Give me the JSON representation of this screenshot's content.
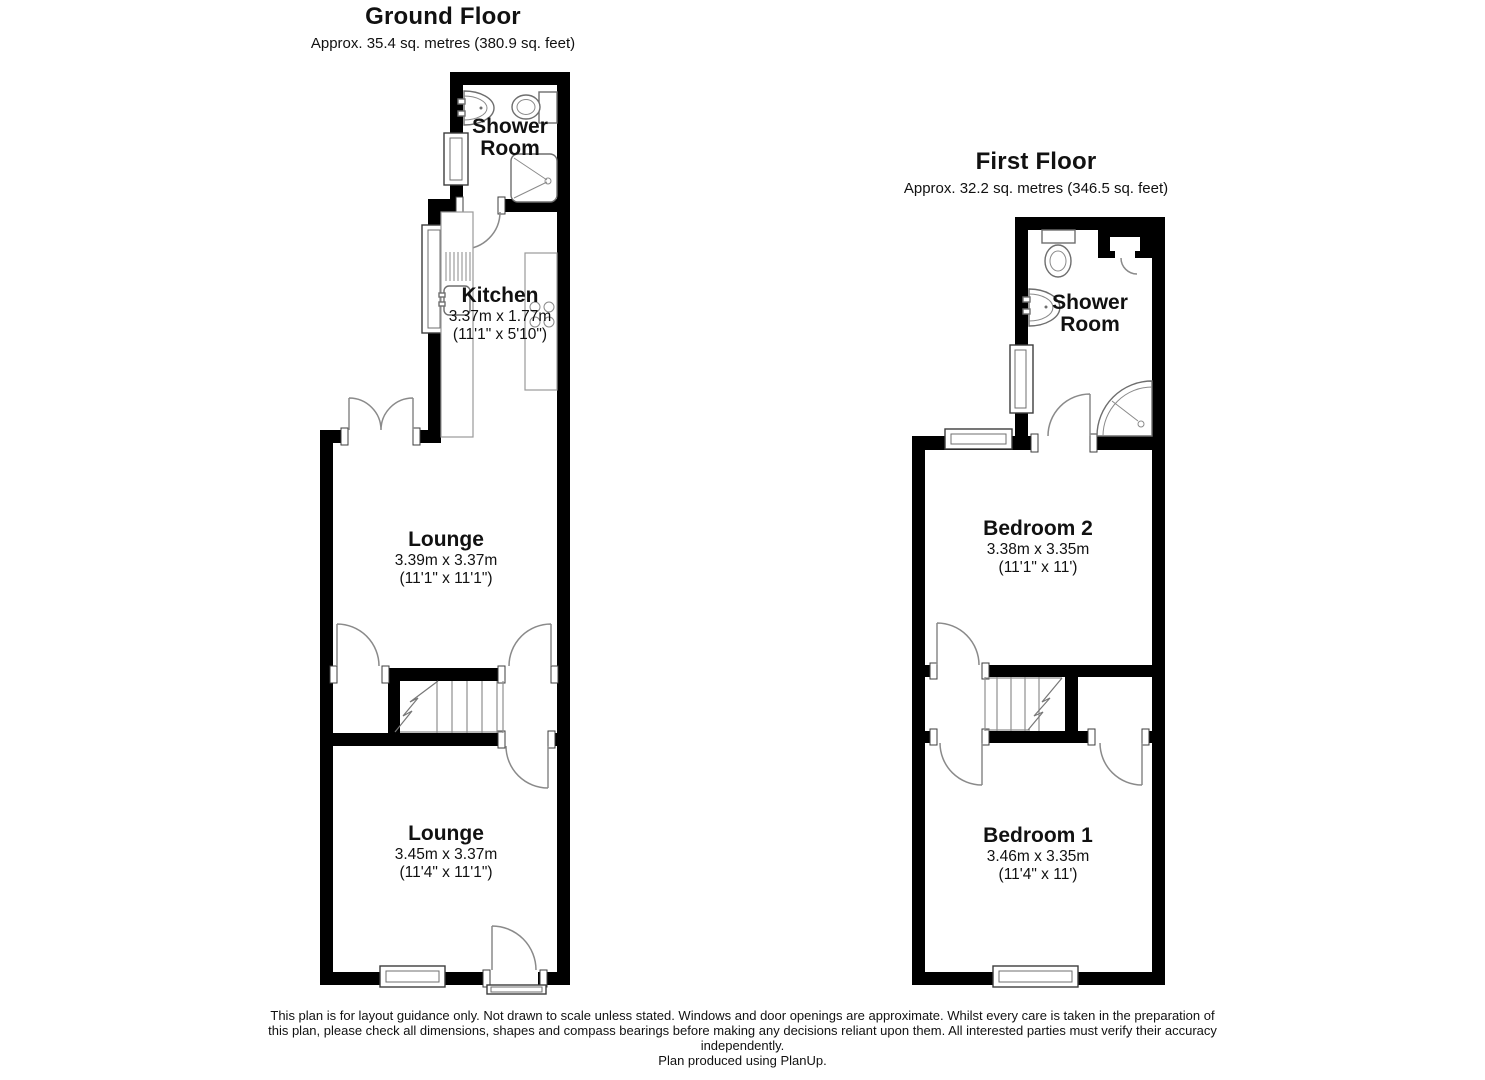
{
  "ground_floor": {
    "title": "Ground Floor",
    "subtitle": "Approx. 35.4 sq. metres (380.9 sq. feet)",
    "rooms": {
      "shower_room": {
        "line1": "Shower",
        "line2": "Room"
      },
      "kitchen": {
        "name": "Kitchen",
        "metric": "3.37m x 1.77m",
        "imperial": "(11'1\" x 5'10\")"
      },
      "lounge_middle": {
        "name": "Lounge",
        "metric": "3.39m x 3.37m",
        "imperial": "(11'1\" x 11'1\")"
      },
      "lounge_front": {
        "name": "Lounge",
        "metric": "3.45m x 3.37m",
        "imperial": "(11'4\" x 11'1\")"
      }
    }
  },
  "first_floor": {
    "title": "First Floor",
    "subtitle": "Approx. 32.2 sq. metres (346.5 sq. feet)",
    "rooms": {
      "shower_room": {
        "line1": "Shower",
        "line2": "Room"
      },
      "bedroom_2": {
        "name": "Bedroom 2",
        "metric": "3.38m x 3.35m",
        "imperial": "(11'1\" x 11')"
      },
      "bedroom_1": {
        "name": "Bedroom 1",
        "metric": "3.46m x 3.35m",
        "imperial": "(11'4\" x 11')"
      }
    }
  },
  "footer": {
    "line1": "This plan is for layout guidance only. Not drawn to scale unless stated. Windows and door openings are approximate. Whilst every care is taken in the preparation of",
    "line2": "this plan, please check all dimensions, shapes and compass bearings before making any decisions reliant upon them. All interested parties must verify their accuracy",
    "line3": "independently.",
    "line4": "Plan produced using PlanUp."
  },
  "colors": {
    "wall": "#000000",
    "symbol_line": "#8a8a8a",
    "text": "#111111",
    "background": "#ffffff"
  }
}
